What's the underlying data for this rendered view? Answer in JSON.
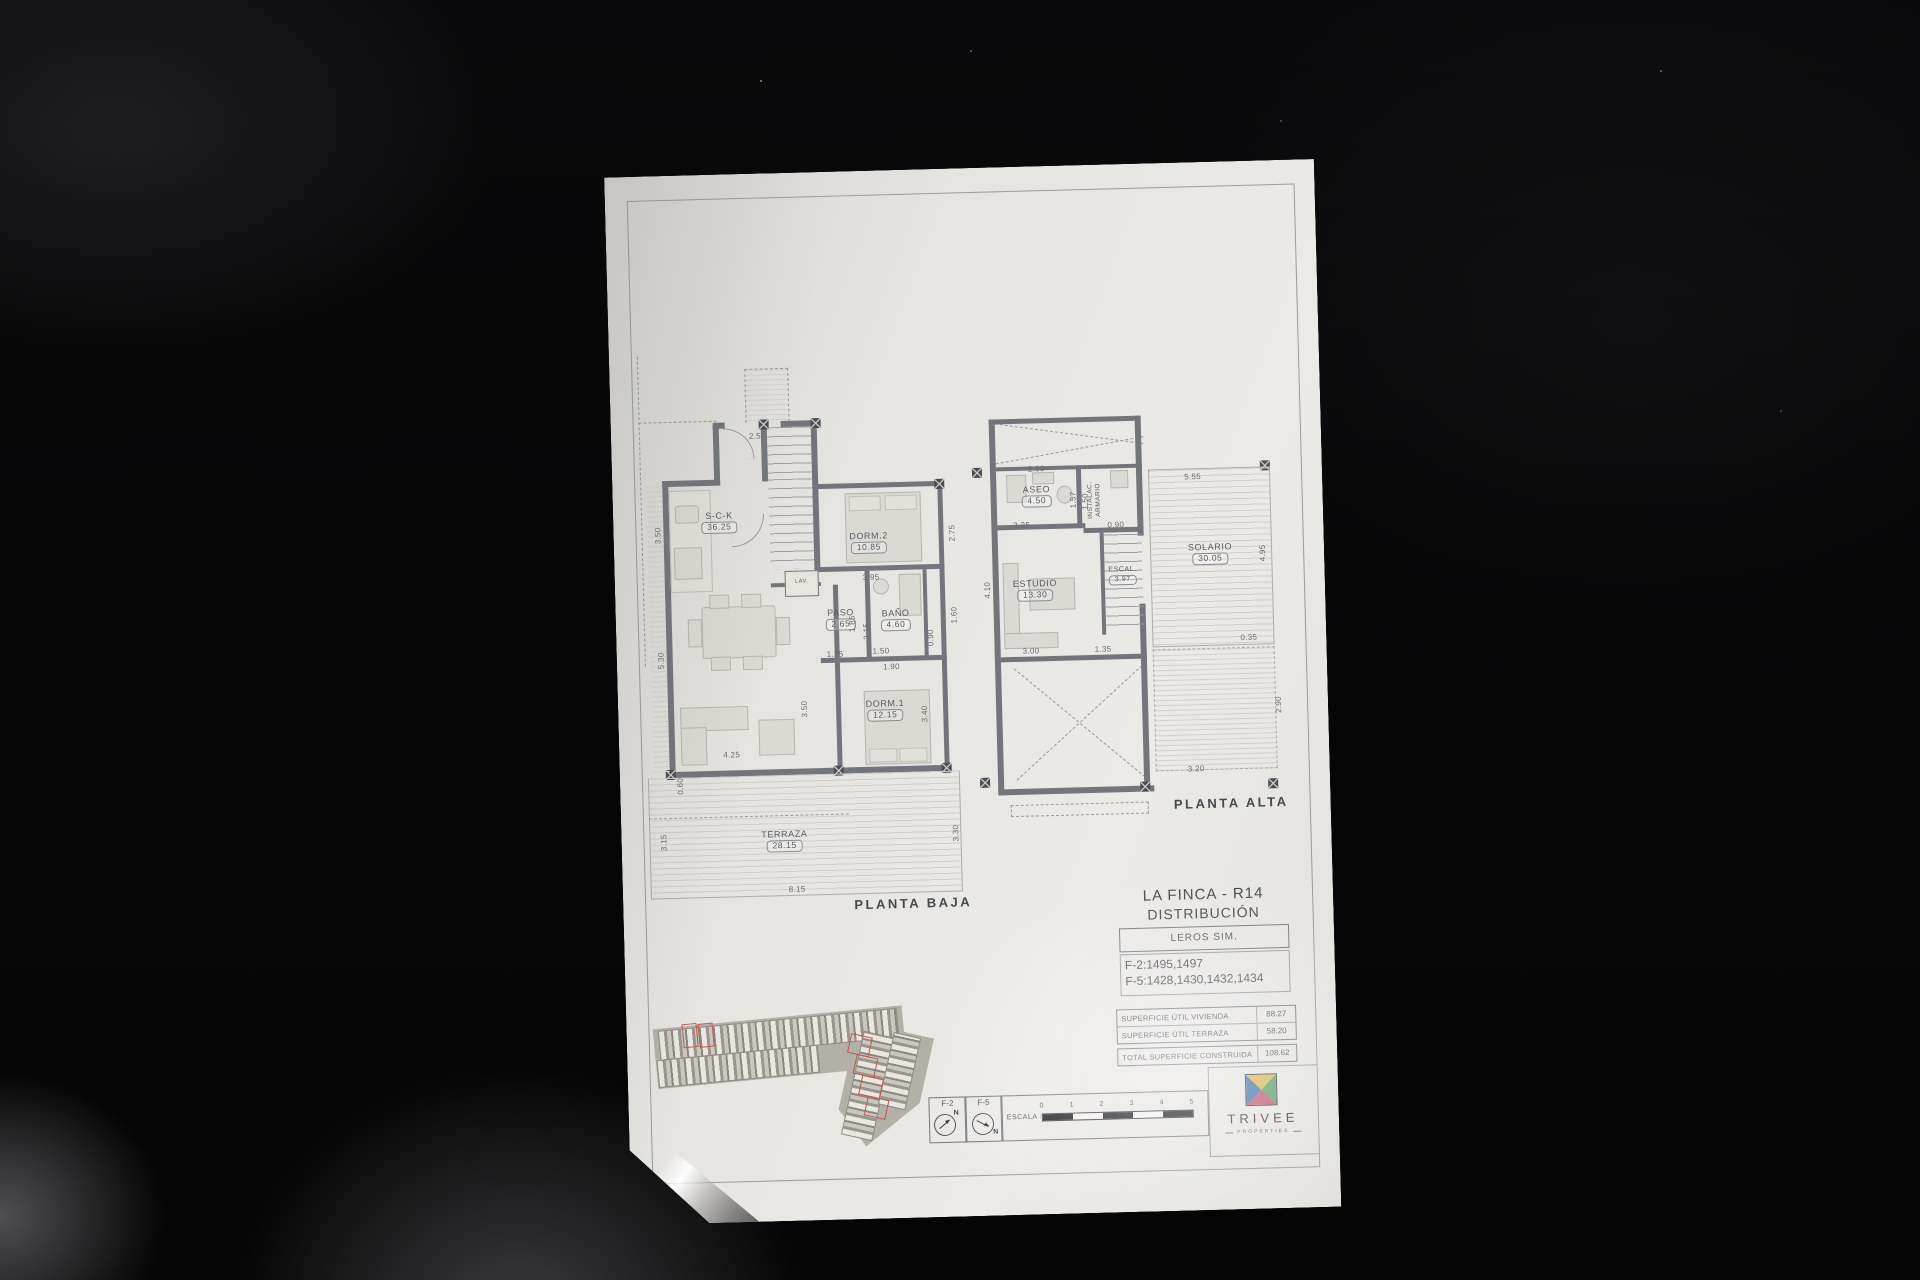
{
  "title_block": {
    "project": "LA FINCA - R14",
    "subtitle": "DISTRIBUCIÓN",
    "model": "LEROS SIM.",
    "units_f2": "F-2:1495,1497",
    "units_f5": "F-5:1428,1430,1432,1434"
  },
  "areas_table": {
    "rows": [
      {
        "label": "SUPERFICIE ÚTIL VIVIENDA",
        "value": "88.27"
      },
      {
        "label": "SUPERFICIE ÚTIL TERRAZA",
        "value": "58.20"
      }
    ],
    "total": {
      "label": "TOTAL SUPERFICIE CONSTRUIDA",
      "value": "108.62"
    }
  },
  "plans": {
    "baja": {
      "caption": "PLANTA BAJA",
      "rooms": {
        "sck": {
          "name": "S-C-K",
          "area": "36.25"
        },
        "paso": {
          "name": "PASO",
          "area": "2.65"
        },
        "bano": {
          "name": "BAÑO",
          "area": "4.60"
        },
        "dorm2": {
          "name": "DORM.2",
          "area": "10.85"
        },
        "dorm1": {
          "name": "DORM.1",
          "area": "12.15"
        },
        "terraza": {
          "name": "TERRAZA",
          "area": "28.15"
        },
        "lav": {
          "name": "LAV."
        }
      },
      "dims": {
        "entry": "2.50",
        "left_top": "3.50",
        "left_bottom": "5.30",
        "kitchen_width": "3.95",
        "paso_h": "1.85",
        "bano_h": "2.15",
        "hall": "1.50",
        "hall2": "1.90",
        "sck_edge": "1.25",
        "closet": "0.90",
        "right_mid": "1.60",
        "right_top": "2.75",
        "dorm1_side": "3.40",
        "terrace_right": "3.30",
        "living_w": "4.25",
        "terrace_w": "8.15",
        "terrace_left": "3.15",
        "corner": "0.60",
        "stair_side": "3.50"
      }
    },
    "alta": {
      "caption": "PLANTA ALTA",
      "rooms": {
        "aseo": {
          "name": "ASEO",
          "area": "4.50"
        },
        "instalac": {
          "name": "INSTALAC.",
          "name2": "ARMARIO"
        },
        "estudio": {
          "name": "ESTUDIO",
          "area": "13.30"
        },
        "escal": {
          "name": "ESCAL.",
          "area": "3.97"
        },
        "solario": {
          "name": "SOLARIO",
          "area": "30.05"
        }
      },
      "dims": {
        "top": "2.90",
        "aseo_w": "3.35",
        "aseo_h": "1.57",
        "inst_h": "1.50",
        "inst_w": "0.90",
        "solario_w": "5.55",
        "solario_h": "4.95",
        "solario_edge": "0.35",
        "estudio_w": "3.00",
        "escal_w": "1.35",
        "estudio_h": "4.10",
        "lower_h": "2.90",
        "lower_w": "3.20"
      }
    }
  },
  "scale_strip": {
    "f2": "F-2",
    "f5": "F-5",
    "north": "N",
    "escala_label": "ESCALA :",
    "ticks": [
      "0",
      "1",
      "2",
      "3",
      "4",
      "5"
    ]
  },
  "logo": {
    "name": "TRIVEE",
    "tagline": "PROPERTIES",
    "colors": {
      "top": "#d9b84d",
      "left": "#4379ad",
      "right": "#5a9e6b",
      "bottom": "#c4586f"
    }
  }
}
